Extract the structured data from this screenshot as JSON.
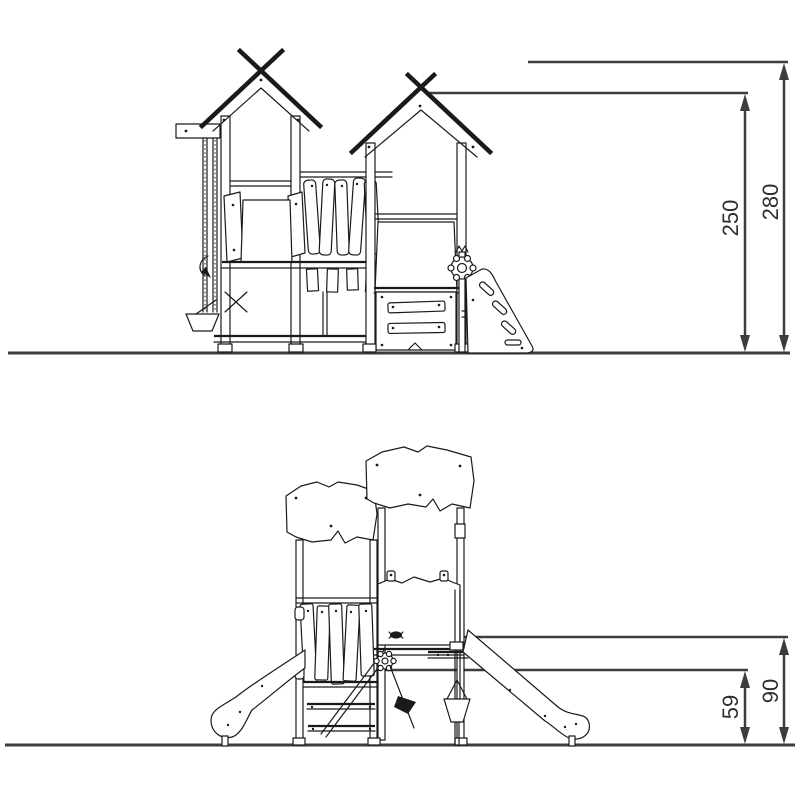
{
  "colors": {
    "background": "#ffffff",
    "structure_line": "#1a1a1a",
    "dimension_line": "#3d3d3d",
    "label_text": "#2e2e2e"
  },
  "upper_view": {
    "dimensions": {
      "inner": "250",
      "outer": "280"
    }
  },
  "lower_view": {
    "dimensions": {
      "inner": "59",
      "outer": "90"
    }
  }
}
